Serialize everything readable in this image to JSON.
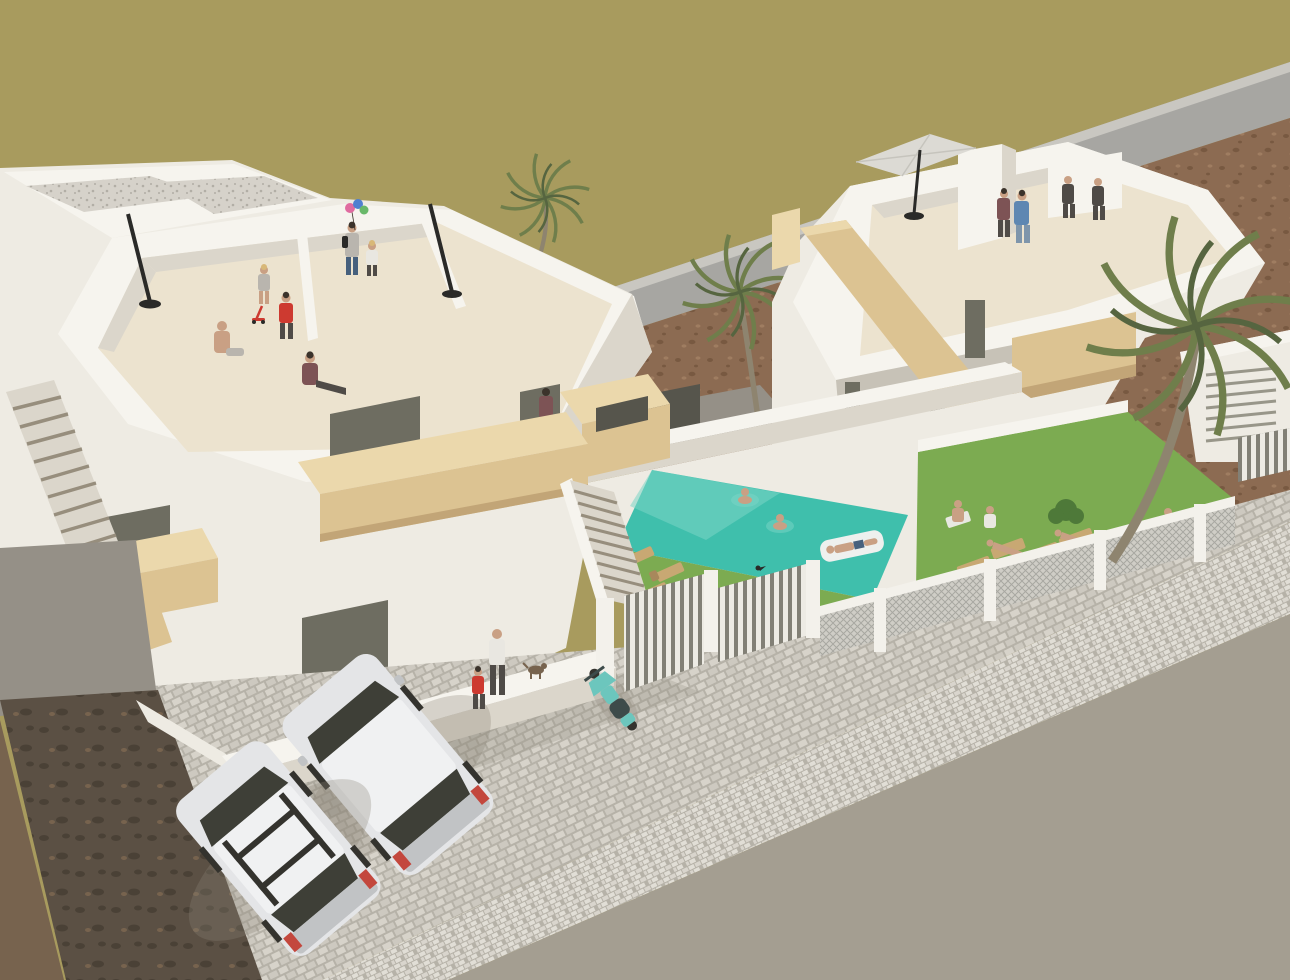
{
  "meta": {
    "description": "Aerial 3D architectural render of a new-build residential development: two modern white villas with rooftop solariums, wooden stair and balcony accents, a turquoise private pool with swimmers, lawns with sun loungers, palm trees, slatted gates and mesh fences, a cobbled street with two parked silver cars and a teal scooter, brown vacant lot and olive scrub field behind",
    "visible_text": "none"
  },
  "colors": {
    "field": "#a89b5e",
    "road_upper": "#a7a6a2",
    "road_edge": "#c9c7c1",
    "dirt_base": "#8c6b52",
    "dirt_dark": "#785941",
    "dirt_light": "#9f7d61",
    "white_top": "#f6f4ee",
    "white_face": "#eeebe3",
    "white_face_shade": "#dbd6cb",
    "white_deep_shade": "#c7c2b7",
    "terrace_floor": "#ece3cf",
    "gravel_base": "#d6d2ca",
    "gravel_dot": "#b2aea5",
    "wood_light": "#ebd8ac",
    "wood": "#dcc392",
    "wood_shade": "#c2a577",
    "glass_dark": "#6e6d61",
    "glass_frame": "#989689",
    "opening_dark": "#56554c",
    "stair_tread": "#978e7d",
    "pool_water": "#3fbfac",
    "pool_light": "#7cd6c6",
    "grass": "#7cab51",
    "bush": "#4e7939",
    "palm_frond": "#6f7e4b",
    "palm_frond_dark": "#566540",
    "palm_trunk": "#8e846f",
    "lounger_wood": "#c8a873",
    "lounger_shade": "#a8885c",
    "cobble_stone": "#d7d3ca",
    "cobble_base": "#cdc9c0",
    "cobble_gap": "#b6b2a8",
    "sidewalk_stone": "#e1ded6",
    "sidewalk_base": "#d9d5cd",
    "asphalt": "#a49e91",
    "dark_ground": "#5b5044",
    "dark_ground_blob": "#4a4136",
    "brown_corner": "#77634e",
    "court_gray": "#959087",
    "fence_white": "#f3f1eb",
    "mesh_fill": "#cfcdc6",
    "mesh_line": "#a8a7a1",
    "slat_backing": "#828076",
    "slat_bar": "#edebe4",
    "umbrella": "#dcdad4",
    "umbrella_rib": "#c6c4bd",
    "pole_black": "#2a2a28",
    "car_body": "#e4e5e7",
    "car_body_shade": "#c1c3c5",
    "car_roof": "#f0f1f2",
    "car_glass": "#3e3f37",
    "car_red": "#c3473d",
    "car_dark": "#34332e",
    "scooter_teal": "#6cc6bd",
    "scooter_dark": "#3d4b4a",
    "skin": "#c9a084",
    "hair_dark": "#3b332b",
    "hair_blond": "#d8b878",
    "shirt_red": "#cd3a30",
    "shirt_blue": "#5e87b2",
    "shirt_white": "#e9e7e1",
    "shirt_gray": "#b9b5ae",
    "shirt_maroon": "#7d5355",
    "pants_dark": "#4f4b47",
    "pants_blue": "#46607d",
    "jeans": "#7e95ab",
    "balloon_pink": "#e06ba0",
    "balloon_blue": "#5080d0",
    "balloon_green": "#69b869",
    "float_white": "#eef0ee",
    "shadow": "#8a8478",
    "towel_white": "#e8e8e2"
  },
  "scene": {
    "setting": "residential development beside an olive scrub field with a brown vacant lot and an upper access road",
    "buildings": [
      {
        "name": "left-villa",
        "features": [
          "rooftop solarium with parapets",
          "gravel roof sections",
          "two tilted parasol poles",
          "wooden balcony bands",
          "external side staircase",
          "central courtyard staircase",
          "dark glass sliding doors"
        ],
        "people_on_roof": 6
      },
      {
        "name": "right-villa",
        "features": [
          "rooftop solarium",
          "cantilever parasol",
          "roof access box",
          "diagonal wooden stair bands",
          "dark window slots"
        ],
        "people_on_roof": 4
      }
    ],
    "pool": {
      "shape": "rectangular",
      "water": "turquoise",
      "swimmers": 2,
      "float": {
        "occupied": true
      }
    },
    "gardens": {
      "lawns": 2,
      "sun_loungers": 9,
      "sunbathers": 5,
      "bush": 1
    },
    "vehicles": [
      {
        "type": "hatchback-car",
        "color": "silver"
      },
      {
        "type": "hatchback-car-with-roof-rails",
        "color": "silver"
      },
      {
        "type": "scooter",
        "color": "teal"
      }
    ],
    "people_total": 21,
    "animals": [
      "small-dog",
      "bird-on-gate"
    ],
    "plants": [
      "palm-tree-small",
      "palm-tree-medium",
      "palm-tree-large"
    ],
    "street": {
      "surfaces": [
        "cobblestone courtyard",
        "cobbled sidewalk",
        "asphalt road"
      ],
      "dark_dirt_corner": true
    },
    "details": [
      "three balloons held by woman on left roof",
      "white pool float",
      "slatted white gates",
      "chain-mesh fence panels with white posts"
    ]
  }
}
